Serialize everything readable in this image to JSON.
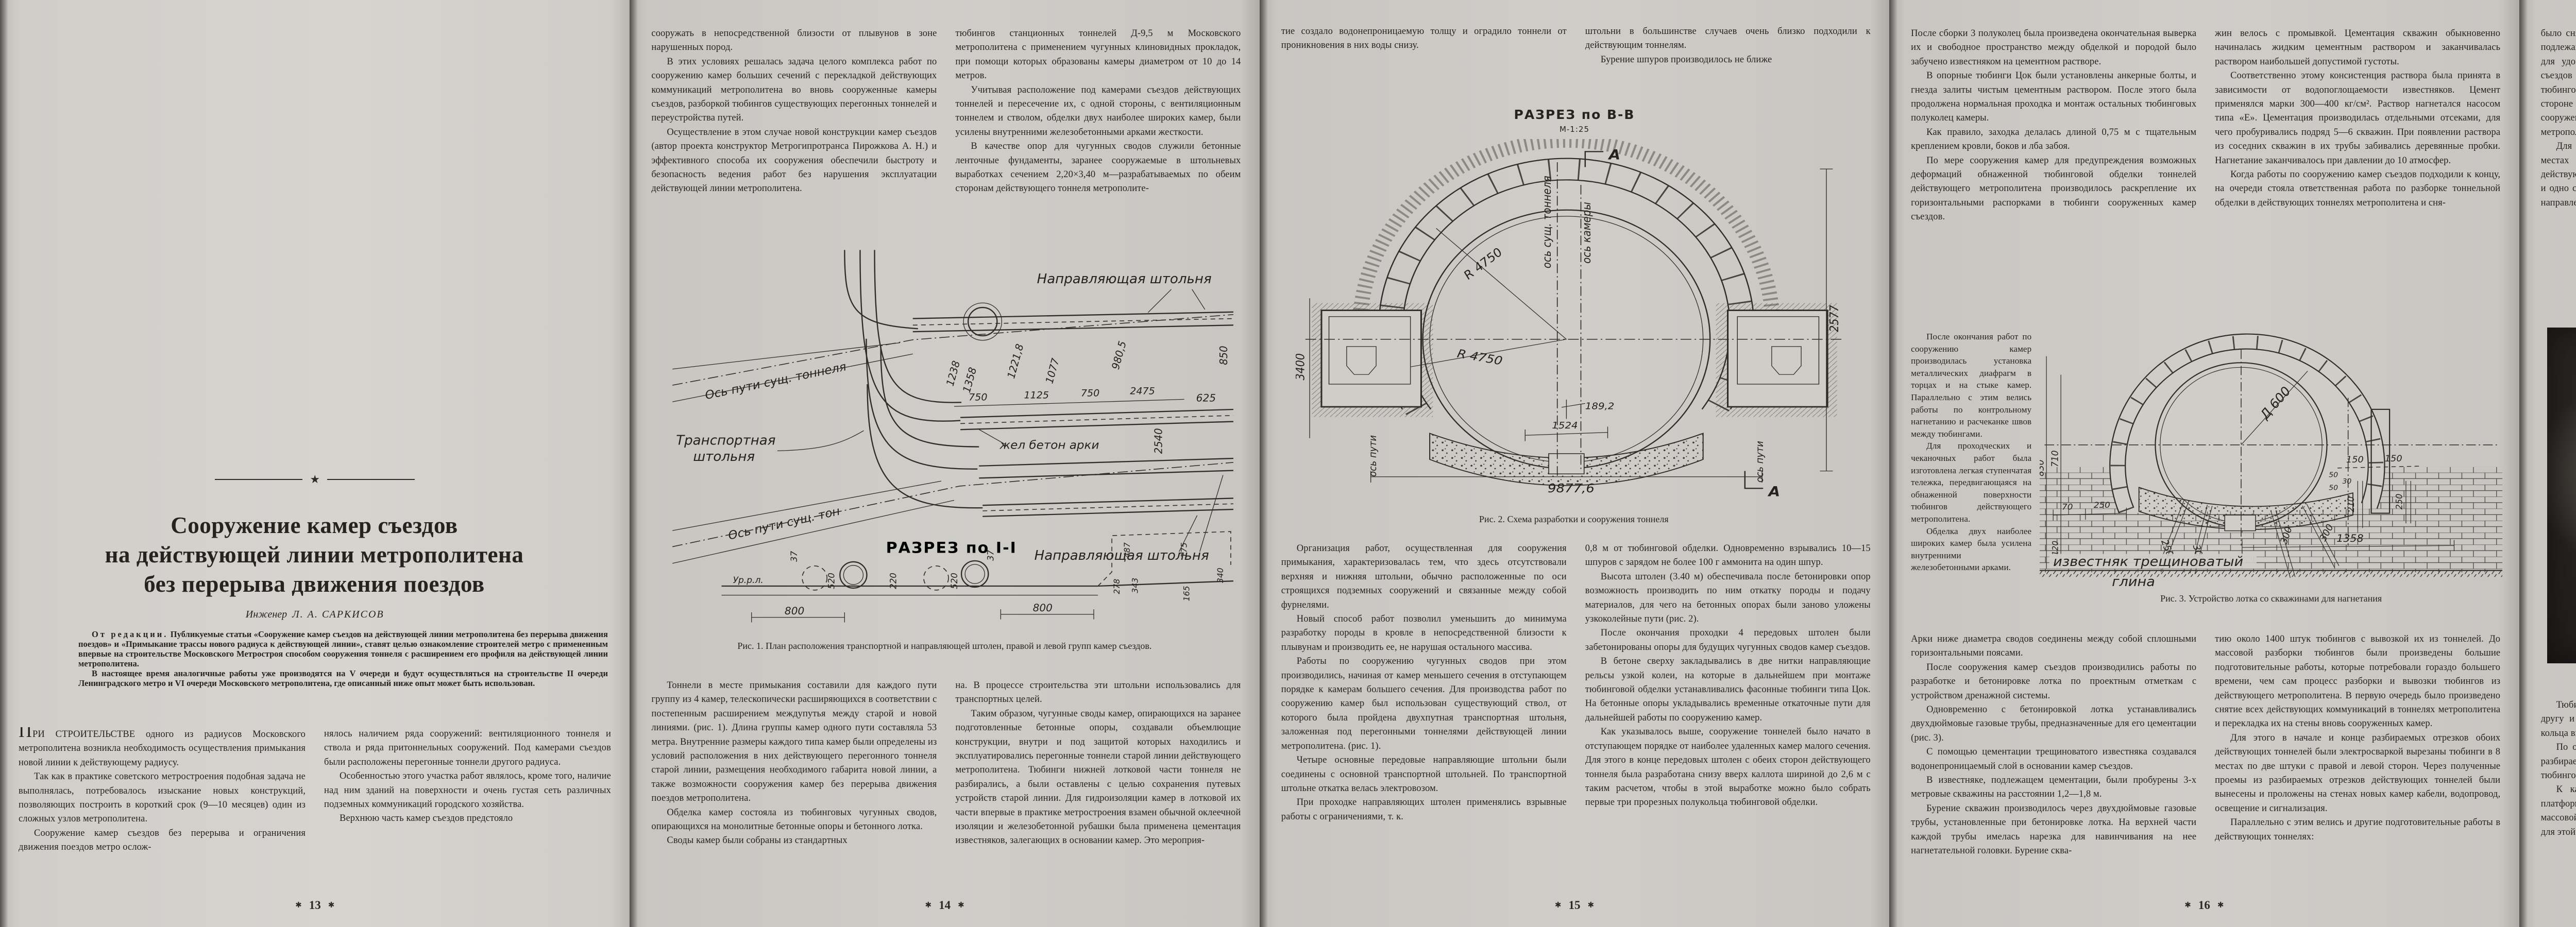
{
  "glyphs": {
    "star": "★",
    "folio_star": "✱"
  },
  "figures": {
    "fig1": {
      "caption": "Рис. 1. План расположения транспортной и направляющей штолен, правой и левой групп камер съездов.",
      "label_guide_top": "Направляющая штольня",
      "label_guide_bottom": "Направляющая штольня",
      "label_transport_1": "Транспортная",
      "label_transport_2": "штольня",
      "label_axis_top": "Ось пути сущ. тоннеля",
      "label_axis_bottom": "Ось пути сущ. тон",
      "label_arches": "жел бетон арки",
      "section_heading": "РАЗРЕЗ по I-I",
      "datum": "Ур.р.л.",
      "dims": [
        "1238",
        "1358",
        "1221,8",
        "1077",
        "980,5",
        "850",
        "2540",
        "625",
        "750",
        "1125",
        "750",
        "2475",
        "37",
        "520",
        "220",
        "520",
        "37",
        "800",
        "800",
        "278",
        "343",
        "487",
        "175",
        "165",
        "340"
      ]
    },
    "fig2": {
      "heading": "РАЗРЕЗ по В-В",
      "scale": "М-1:25",
      "caption": "Рис. 2. Схема разработки и сооружения тоннеля",
      "label_axis_tunnel": "ось сущ. тоннеля",
      "label_axis_chamber": "ось камеры",
      "label_axis_track_left": "ось пути",
      "label_axis_track_right": "ось пути",
      "radius": "R 4750",
      "marker": "А",
      "dims": [
        "9877,6",
        "1524",
        "189,2",
        "2577",
        "3400"
      ]
    },
    "fig3": {
      "caption": "Рис. 3. Устройство лотка со скважинами для нагнетания",
      "diameter": "Д 600",
      "label_limestone": "известняк трещиноватый",
      "label_clay": "глина",
      "dims": [
        "830",
        "710",
        "120",
        "70",
        "250",
        "250",
        "300",
        "300",
        "300",
        "210",
        "250",
        "150",
        "150",
        "50",
        "30",
        "50",
        "1358"
      ]
    },
    "fig4": {
      "caption": "Рис. 4. Вид камеры после разборки обделки перегонного тоннеля без перерыва движения"
    }
  },
  "pages": {
    "p13": {
      "folio": "13",
      "title": [
        "Сооружение камер съездов",
        "на действующей линии метрополитена",
        "без перерыва движения поездов"
      ],
      "author_prefix": "Инженер",
      "author_name": "Л. А. САРКИСОВ",
      "editorial_lead": "От редакции.",
      "editorial_p1": " Публикуемые статьи «Сооружение камер съездов на действующей линии метрополитена без перерыва движения поездов» и «Примыкание трассы нового радиуса к действующей линии», ставят целью ознакомление строителей метро с примененным впервые на строительстве Московского Метростроя способом сооружения тоннеля с расширением его профиля на действующей линии метрополитена.",
      "editorial_p2": "В настоящее время аналогичные работы уже производятся на V очереди и будут осуществляться на строительстве II очереди Ленинградского метро и VI очереди Московского метрополитена, где описанный ниже опыт может быть использован.",
      "col1": [
        "ПРИ СТРОИТЕЛЬСТВЕ одного из радиусов Московского метрополитена возникла необходимость осуществления примыкания новой линии к действующему радиусу.",
        "Так как в практике советского метростроения подобная задача не выполнялась, потребовалось изыскание новых конструкций, позволяющих построить в короткий срок (9—10 месяцев) один из сложных узлов метрополитена.",
        "Сооружение камер съездов без перерыва и ограничения движения поездов метро ослож-"
      ],
      "col2": [
        "нялось наличием ряда сооружений: вентиляционного тоннеля и ствола и ряда притоннельных сооружений. Под камерами съездов были расположены перегонные тоннели другого радиуса.",
        "Особенностью этого участка работ являлось, кроме того, наличие над ним зданий на поверхности и очень густая сеть различных подземных коммуникаций городского хозяйства.",
        "Верхнюю часть камер съездов предстояло"
      ]
    },
    "p14": {
      "folio": "14",
      "col1_top": [
        "сооружать в непосредственной близости от плывунов в зоне нарушенных пород.",
        "В этих условиях решалась задача целого комплекса работ по сооружению камер больших сечений с перекладкой действующих коммуникаций метрополитена во вновь сооруженные камеры съездов, разборкой тюбингов существующих перегонных тоннелей и переустройства путей.",
        "Осуществление в этом случае новой конструкции камер съездов (автор проекта конструктор Метрогипротранса Пирожкова А. Н.) и эффективного способа их сооружения обеспечили быстроту и безопасность ведения работ без нарушения эксплуатации действующей линии метрополитена."
      ],
      "col2_top": [
        "тюбингов станционных тоннелей Д-9,5 м Московского метрополитена с применением чугунных клиновидных прокладок, при помощи которых образованы камеры диаметром от 10 до 14 метров.",
        "Учитывая расположение под камерами съездов действующих тоннелей и пересечение их, с одной стороны, с вентиляционным тоннелем и стволом, обделки двух наиболее широких камер, были усилены внутренними железобетонными арками жесткости.",
        "В качестве опор для чугунных сводов служили бетонные ленточные фундаменты, заранее сооружаемые в штольневых выработках сечением 2,20×3,40 м—разрабатываемых по обеим сторонам действующего тоннеля метрополите-"
      ],
      "col1_bottom": [
        "Тоннели в месте примыкания составили для каждого пути группу из 4 камер, телескопически расширяющихся в соответствии с постепенным расширением междупутья между старой и новой линиями. (рис. 1). Длина группы камер одного пути составляла 53 метра. Внутренние размеры каждого типа камер были определены из условий расположения в них действующего перегонного тоннеля старой линии, размещения необходимого габарита новой линии, а также возможности сооружения камер без перерыва движения поездов метрополитена.",
        "Обделка камер состояла из тюбинговых чугунных сводов, опирающихся на монолитные бетонные опоры и бетонного лотка.",
        "Своды камер были собраны из стандартных"
      ],
      "col2_bottom": [
        "на. В процессе строительства эти штольни использовались для транспортных целей.",
        "Таким образом, чугунные своды камер, опирающихся на заранее подготовленные бетонные опоры, создавали объемлющие конструкции, внутри и под защитой которых находились и эксплуатировались перегонные тоннели старой линии действующего метрополитена. Тюбинги нижней лотковой части тоннеля не разбирались, а были оставлены с целью сохранения путевых устройств старой линии. Для гидроизоляции камер в лотковой их части впервые в практике метростроения взамен обычной оклеечной изоляции и железобетонной рубашки была применена цементация известняков, залегающих в основании камер. Это мероприя-"
      ]
    },
    "p15": {
      "folio": "15",
      "col1_top": [
        "тие создало водонепроницаемую толщу и оградило тоннели от проникновения в них воды снизу."
      ],
      "col2_top": [
        "штольни в большинстве случаев очень близко подходили к действующим тоннелям.",
        "Бурение шпуров производилось не ближе"
      ],
      "col1_bottom": [
        "Организация работ, осуществленная для сооружения примыкания, характеризовалась тем, что здесь отсутствовали верхняя и нижняя штольни, обычно расположенные по оси строящихся подземных сооружений и связанные между собой фурнелями.",
        "Новый способ работ позволил уменьшить до минимума разработку породы в кровле в непосредственной близости к плывунам и производить ее, не нарушая остального массива.",
        "Работы по сооружению чугунных сводов при этом производились, начиная от камер меньшего сечения в отступающем порядке к камерам большего сечения. Для производства работ по сооружению камер был использован существующий ствол, от которого была пройдена двухпутная транспортная штольня, заложенная под перегонными тоннелями действующей линии метрополитена. (рис. 1).",
        "Четыре основные передовые направляющие штольни были соединены с основной транспортной штольней. По транспортной штольне откатка велась электровозом.",
        "При проходке направляющих штолен применялись взрывные работы с ограничениями, т. к."
      ],
      "col2_bottom": [
        "0,8 м от тюбинговой обделки. Одновременно взрывались 10—15 шпуров с зарядом не более 100 г аммонита на один шпур.",
        "Высота штолен (3.40 м) обеспечивала после бетонировки опор возможность производить по ним откатку породы и подачу материалов, для чего на бетонных опорах были заново уложены узкоколейные пути (рис. 2).",
        "После окончания проходки 4 передовых штолен были забетонированы опоры для будущих чугунных сводов камер съездов.",
        "В бетоне сверху закладывались в две нитки направляющие рельсы узкой колеи, на которые в дальнейшем при монтаже тюбинговой обделки устанавливались фасонные тюбинги типа Цок. На бетонные опоры укладывались временные откаточные пути для дальнейшей работы по сооружению камер.",
        "Как указывалось выше, сооружение тоннелей было начато в отступающем порядке от наиболее удаленных камер малого сечения. Для этого в конце передовых штолен с обеих сторон действующего тоннеля была разработана снизу вверх каллота шириной до 2,6 м с таким расчетом, чтобы в этой выработке можно было собрать первые три прорезных полукольца тюбинговой обделки."
      ]
    },
    "p16": {
      "folio": "16",
      "col1_top": [
        "После сборки 3 полуколец была произведена окончательная выверка их и свободное пространство между обделкой и породой было забучено известняком на цементном растворе.",
        "В опорные тюбинги Цок были установлены анкерные болты, и гнезда залиты чистым цементным раствором. После этого была продолжена нормальная проходка и монтаж остальных тюбинговых полуколец камеры.",
        "Как правило, заходка делалась длиной 0,75 м с тщательным креплением кровли, боков и лба забоя.",
        "По мере сооружения камер для предупреждения возможных деформаций обнаженной тюбинговой обделки тоннелей действующего метрополитена производилось раскрепление их горизонтальными распорками в тюбинги сооруженных камер съездов."
      ],
      "col2_top": [
        "жин велось с промывкой. Цементация скважин обыкновенно начиналась жидким цементным раствором и заканчивалась раствором наибольшей допустимой густоты.",
        "Соответственно этому консистенция раствора была принята в зависимости от водопоглощаемости известняков. Цемент применялся марки 300—400 кг/см². Раствор нагнетался насосом типа «Е». Цементация производилась отдельными отсеками, для чего пробуривались подряд 5—6 скважин. При появлении раствора из соседних скважин в их трубы забивались деревянные пробки. Нагнетание заканчивалось при давлении до 10 атмосфер.",
        "Когда работы по сооружению камер съездов подходили к концу, на очереди стояла ответственная работа по разборке тоннельной обделки в действующих тоннелях метрополитена и сня-"
      ],
      "col_narrow": [
        "После окончания работ по сооружению камер производилась установка металлических диафрагм в торцах и на стыке камер. Параллельно с этим велись работы по контрольному нагнетанию и расчеканке швов между тюбингами.",
        "Для проходческих и чеканочных работ была изготовлена легкая ступенчатая тележка, передвигающаяся на обнаженной поверхности тюбингов действующего метрополитена.",
        "Обделка двух наиболее широких камер была усилена внутренними железобетонными арками."
      ],
      "col1_bottom": [
        "Арки ниже диаметра сводов соединены между собой сплошными горизонтальными поясами.",
        "После сооружения камер съездов производились работы по разработке и бетонировке лотка по проектным отметкам с устройством дренажной системы.",
        "Одновременно с бетонировкой лотка устанавливались двухдюймовые газовые трубы, предназначенные для его цементации (рис. 3).",
        "С помощью цементации трещиноватого известняка создавался водонепроницаемый слой в основании камер съездов.",
        "В известняке, подлежащем цементации, были пробурены 3-х метровые скважины на расстоянии 1,2—1,8 м.",
        "Бурение скважин производилось через двухдюймовые газовые трубы, установленные при бетонировке лотка. На верхней части каждой трубы имелась нарезка для навинчивания на нее нагнетательной головки. Бурение сква-"
      ],
      "col2_bottom": [
        "тию около 1400 штук тюбингов с вывозкой их из тоннелей. До массовой разборки тюбингов были произведены большие подготовительные работы, которые потребовали гораздо большего времени, чем сам процесс разборки и вывозки тюбингов из действующего метрополитена. В первую очередь было произведено снятие всех действующих коммуникаций в тоннелях метрополитена и перекладка их на стены вновь сооруженных камер.",
        "Для этого в начале и конце разбираемых отрезков обоих действующих тоннелей были электросваркой вырезаны тюбинги в 8 местах по две штуки с правой и левой сторон. Через полученные проемы из разбираемых отрезков действующих тоннелей были вынесены и проложены на стенах новых камер кабели, водопровод, освещение и сигнализация.",
        "Параллельно с этим велись и другие подготовительные работы в действующих тоннелях:"
      ]
    },
    "p17": {
      "folio": "17",
      "col1_top": [
        "было снято до 50—60% болтов по фланцам и в торцах тюбингов, подлежащих разборке; выполнена разбивка бетонного заполнения для удобства разбалчивания тюбингов; в обеих группах камер съездов установлено 12 редукторных лебедок для разборки тюбингов. Лебедки были установлены в безопасных местах в стороне от путей в больших камерах съездов, в притоннельных сооружениях и ходках, примыкающих в тоннелям действующего метрополитена.",
        "Для предоставления широкого фронта работ по разборке в 3 местах тюбинговой обделки в каждом отрезке разбираемого действующего тоннеля в первую очередь разбирались одно крайнее и одно среднее кольца, что давало возможность вести разборку в 3 направлениях."
      ],
      "col2_top": [
        "Операции по снятию тюбингов заключались в следующем: в замковой части сводов и по бокам камер подвешивались блоки, через которые пропускались тросы от редукторных лебедок. В первую очередь снимались сразу два предзамковых вместе с замковым тюбингом, а затем остальные тюбинги.",
        "Все работы по снятию тюбингов производились только в ночное время после снятия напряжения в действующих тоннелях метрополитена. На разборке тюбингов были достигнуты большие темпы. Каждая бригада за 3—3,5 часа разбирала до 30 штук тюбингов, и разборка обделки в обеих группах камер съездов была закончена в течение 22—25 ночей (рис. 4)."
      ],
      "col1_bottom": [
        "Тюбинговые кольца обделки были очень плотно прижаты друг к другу и снятие их одними лебедками было затруднено, крайние кольца вырезались электросваркой.",
        "По окончании всех подготовительных работ в каждом отрезке разбираемого участка был открыт широкий фронт по разборке тюбингов для одновременного ведения работ в трех местах.",
        "К каждой точке к 2.00 часам ночи подавался мотовоз с платформой для вывозки снятых тюбингов, и бригады приступали к массовой разборке и погрузке тюбингов на платформы, используя для этой цели редукторные лебедки."
      ],
      "col2_bottom": [
        "После разборки тюбингов в лотковой части тоннеля производилась срезка их выступающих концов, которые мешали укладке стрелочного перевода в камерах съездов.",
        "В сооруженных камерах съездов параллельно с основными работами велись подготовительные работы по перекладке и опусканию путей, а также врезка стрелочных переводов.",
        "Опыт работы, приобретенный коллективом строителей при сооружении примыкания к действующему радиусу метрополитена, ценен тем, что позволяет по мере развития городского движения, решать вопросы реконструкции действующих перегонных тоннелей в станционные, без перерыва движения поездов."
      ]
    }
  }
}
